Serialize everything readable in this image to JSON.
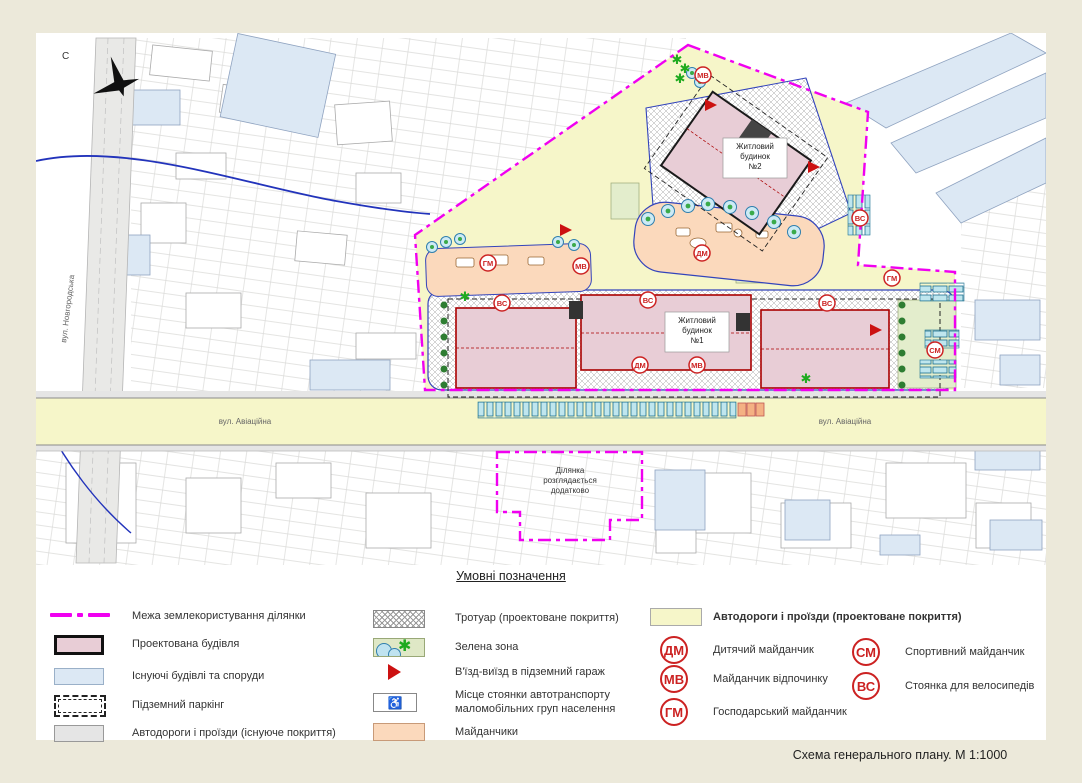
{
  "title": "Схема  генерального плану. М 1:1000",
  "map": {
    "north_label": "С",
    "street_novhorodska": "вул. Новгородська",
    "street_aviatsiina": "вул. Авіаційна",
    "building1_lines": [
      "Житловий",
      "будинок",
      "№1"
    ],
    "building2_lines": [
      "Житловий",
      "будинок",
      "№2"
    ],
    "plot_note_lines": [
      "Ділянка",
      "розглядається",
      "додатково"
    ],
    "badges": [
      "МВ",
      "ДМ",
      "МВ",
      "ГМ",
      "ВС",
      "ВС",
      "ВС",
      "ДМ",
      "МВ",
      "СМ",
      "ГМ",
      "ВС"
    ]
  },
  "legend": {
    "heading": "Умовні позначення",
    "boundary": "Межа землекористування ділянки",
    "proposed_building": "Проектована будівля",
    "existing_buildings": "Існуючі будівлі та споруди",
    "underground_parking": "Підземний паркінг",
    "roads_existing": "Автодороги і проїзди (існуюче покриття)",
    "sidewalk": "Тротуар (проектоване покриття)",
    "green_zone": "Зелена зона",
    "garage_entry": "В'їзд-виїзд в підземний гараж",
    "disabled_parking_line1": "Місце стоянки автотранспорту",
    "disabled_parking_line2": "маломобільних груп населення",
    "playgrounds": "Майданчики",
    "roads_proposed": "Автодороги і проїзди (проектоване покриття)",
    "dm_label": "ДМ",
    "dm_text": "Дитячий майданчик",
    "mv_label": "МВ",
    "mv_text": "Майданчик відпочинку",
    "gm_label": "ГМ",
    "gm_text": "Господарський майданчик",
    "sm_label": "СМ",
    "sm_text": "Спортивний майданчик",
    "vs_label": "ВС",
    "vs_text": "Стоянка для велосипедів"
  },
  "colors": {
    "page_bg": "#ece9da",
    "boundary_magenta": "#f000f0",
    "proposed_building_pink": "#e8cdd6",
    "existing_blue": "#dce8f4",
    "road_yellow": "#f6f6c9",
    "road_gray": "#e5e5e5",
    "playground_peach": "#fbd9bc",
    "green_zone": "#dfe8c6",
    "badge_red": "#cc2222"
  }
}
